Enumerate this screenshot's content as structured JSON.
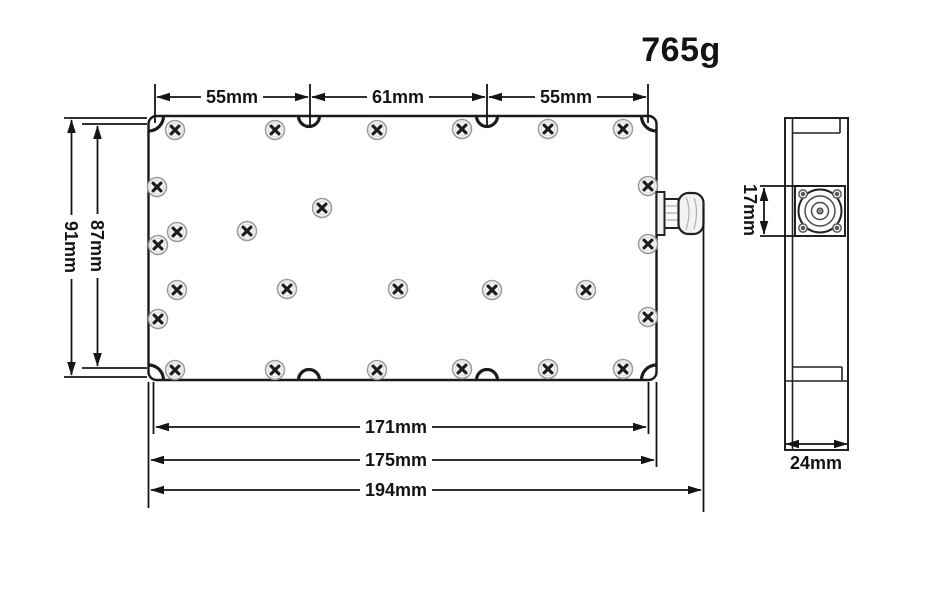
{
  "drawing": {
    "weight_label": "765g",
    "top_view": {
      "top_dimensions": [
        {
          "label": "55mm"
        },
        {
          "label": "61mm"
        },
        {
          "label": "55mm"
        }
      ],
      "left_dimensions": {
        "outer": "91mm",
        "inner": "87mm"
      },
      "bottom_dimensions": {
        "inner": "171mm",
        "body": "175mm",
        "overall": "194mm"
      }
    },
    "side_view": {
      "connector_height": "17mm",
      "depth": "24mm"
    },
    "colors": {
      "line": "#1b1b1b",
      "background": "#ffffff"
    }
  }
}
